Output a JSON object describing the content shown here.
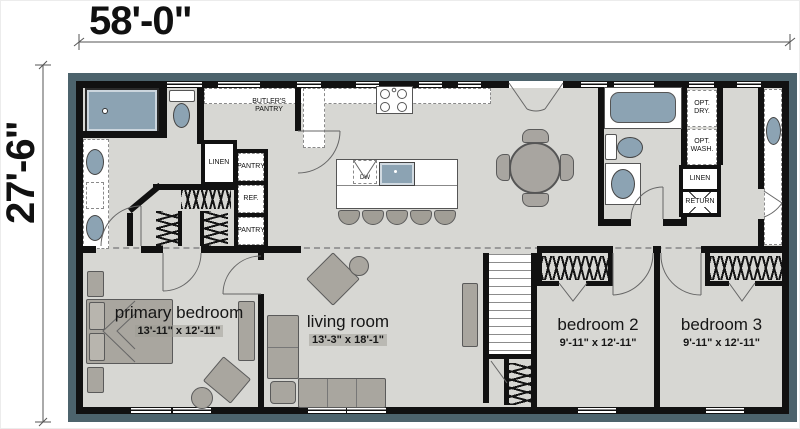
{
  "dimensions": {
    "width": "58'-0\"",
    "height": "27'-6\""
  },
  "rooms": {
    "primary_bedroom": {
      "name": "primary bedroom",
      "size": "13'-11\" x 12'-11\""
    },
    "living_room": {
      "name": "living room",
      "size": "13'-3\" x 18'-1\""
    },
    "bedroom_2": {
      "name": "bedroom 2",
      "size": "9'-11\" x 12'-11\""
    },
    "bedroom_3": {
      "name": "bedroom 3",
      "size": "9'-11\" x 12'-11\""
    }
  },
  "labels": {
    "butlers_pantry": "BUTLER'S PANTRY",
    "linen_1": "LINEN",
    "pantry_1": "PANTRY",
    "ref": "REF.",
    "pantry_2": "PANTRY",
    "dw": "DW",
    "opt_dry": "OPT. DRY.",
    "opt_wash": "OPT. WASH.",
    "linen_2": "LINEN",
    "return": "RETURN"
  },
  "colors": {
    "wall": "#111111",
    "floor": "#d7d7d3",
    "shadow": "#4c636c",
    "fixture_blue": "#8ca3b3",
    "furniture_gray": "#a9a69f",
    "counter_white": "#ffffff"
  }
}
